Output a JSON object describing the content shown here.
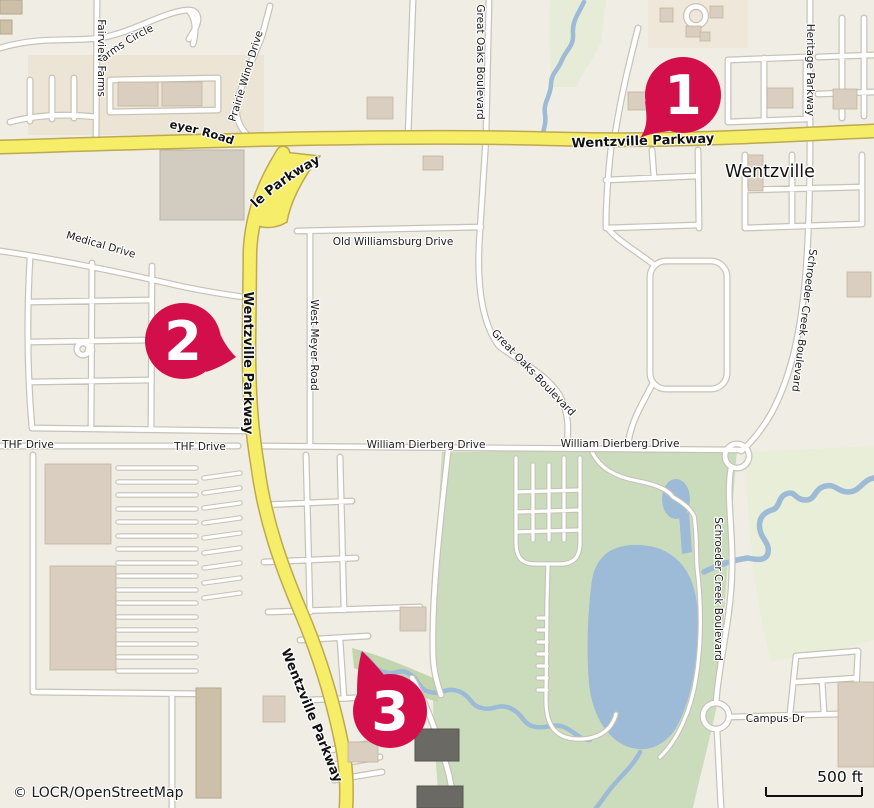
{
  "map": {
    "attribution": "© LOCR/OpenStreetMap",
    "scale_bar": {
      "label": "500 ft"
    },
    "city_label": "Wentzville",
    "road_labels": {
      "wentzville_parkway": "Wentzville Parkway",
      "west_meyer_road": "West Meyer Road",
      "fairview_farms": "Fairview Farms",
      "fairview_farms_circle": "Fairview Farms Circle",
      "prairie_wind_drive": "Prairie Wind Drive",
      "great_oaks_boulevard": "Great Oaks Boulevard",
      "old_williamsburg_drive": "Old Williamsburg Drive",
      "medical_drive": "Medical Drive",
      "heritage_parkway": "Heritage Parkway",
      "schroeder_creek_boulevard": "Schroeder Creek Boulevard",
      "thf_drive": "THF Drive",
      "william_dierberg_drive": "William Dierberg Drive",
      "campus_drive": "Campus Dr"
    },
    "markers": [
      {
        "number": "1"
      },
      {
        "number": "2"
      },
      {
        "number": "3"
      }
    ],
    "colors": {
      "marker": "#D30F4B",
      "primary-road": "#F6ED68",
      "primary-casing": "#BDA94E",
      "minor-road": "#FFFFFF",
      "minor-casing": "#C6C2B7",
      "water": "#9DBAD6",
      "park": "#CBDCBD",
      "background": "#F0EDE4"
    }
  }
}
